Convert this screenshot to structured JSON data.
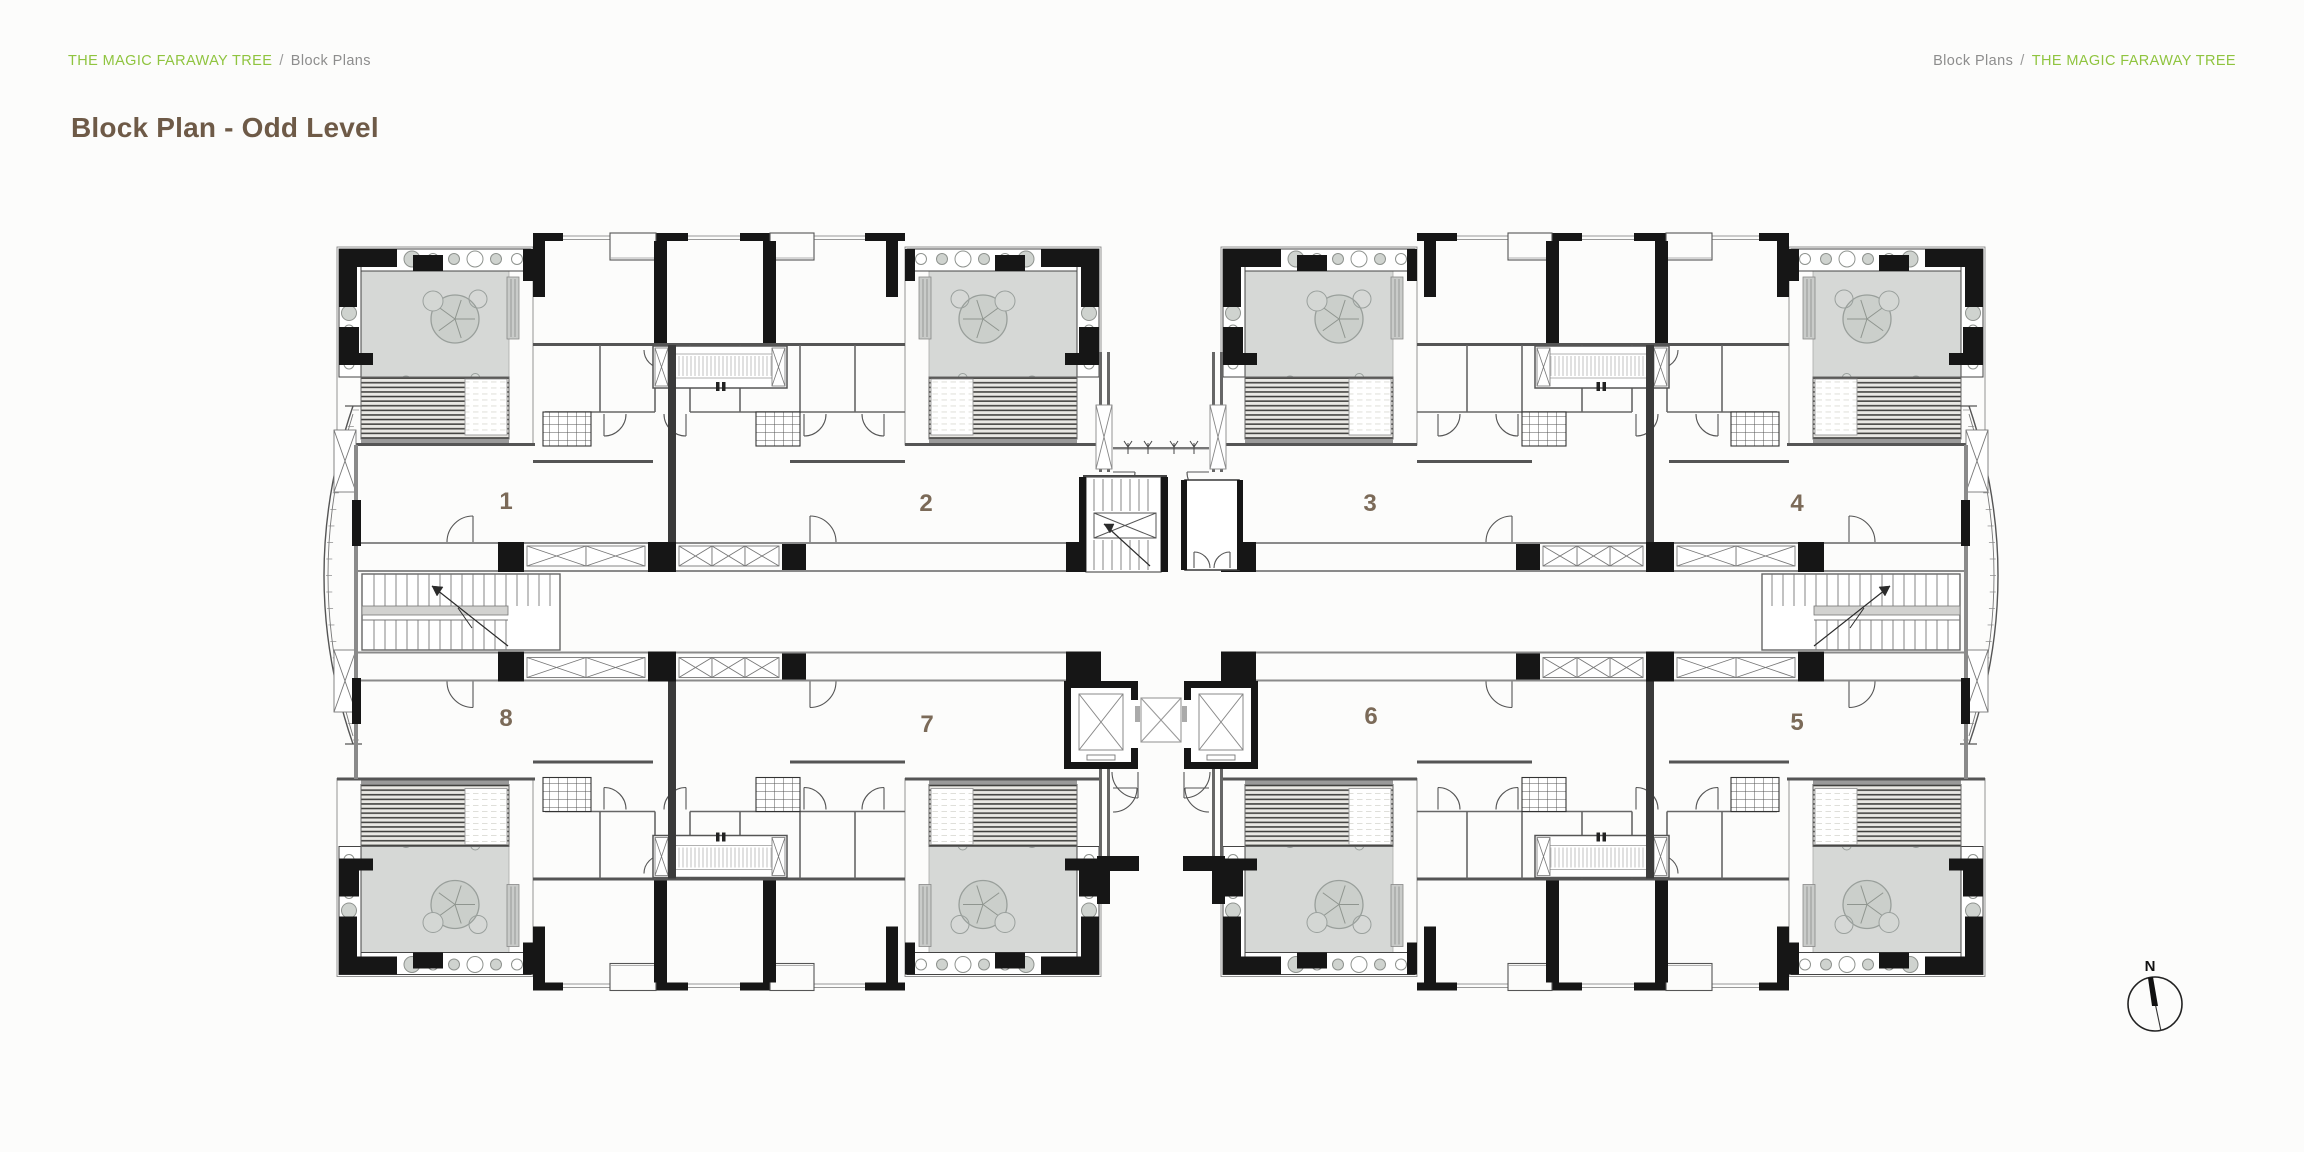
{
  "header": {
    "breadcrumb_left": {
      "project": "THE MAGIC FARAWAY TREE",
      "separator": "/",
      "section": "Block Plans"
    },
    "breadcrumb_right": {
      "section": "Block Plans",
      "separator": "/",
      "project": "THE MAGIC FARAWAY TREE"
    }
  },
  "title": "Block Plan - Odd Level",
  "plan": {
    "units": [
      {
        "label": "1"
      },
      {
        "label": "2"
      },
      {
        "label": "3"
      },
      {
        "label": "4"
      },
      {
        "label": "8"
      },
      {
        "label": "7"
      },
      {
        "label": "6"
      },
      {
        "label": "5"
      }
    ]
  },
  "compass": {
    "label": "N"
  },
  "colors": {
    "accent_green": "#8fc43f",
    "breadcrumb_gray": "#8d8d8d",
    "title_brown": "#6e5a47",
    "unit_brown": "#7b6a58"
  }
}
